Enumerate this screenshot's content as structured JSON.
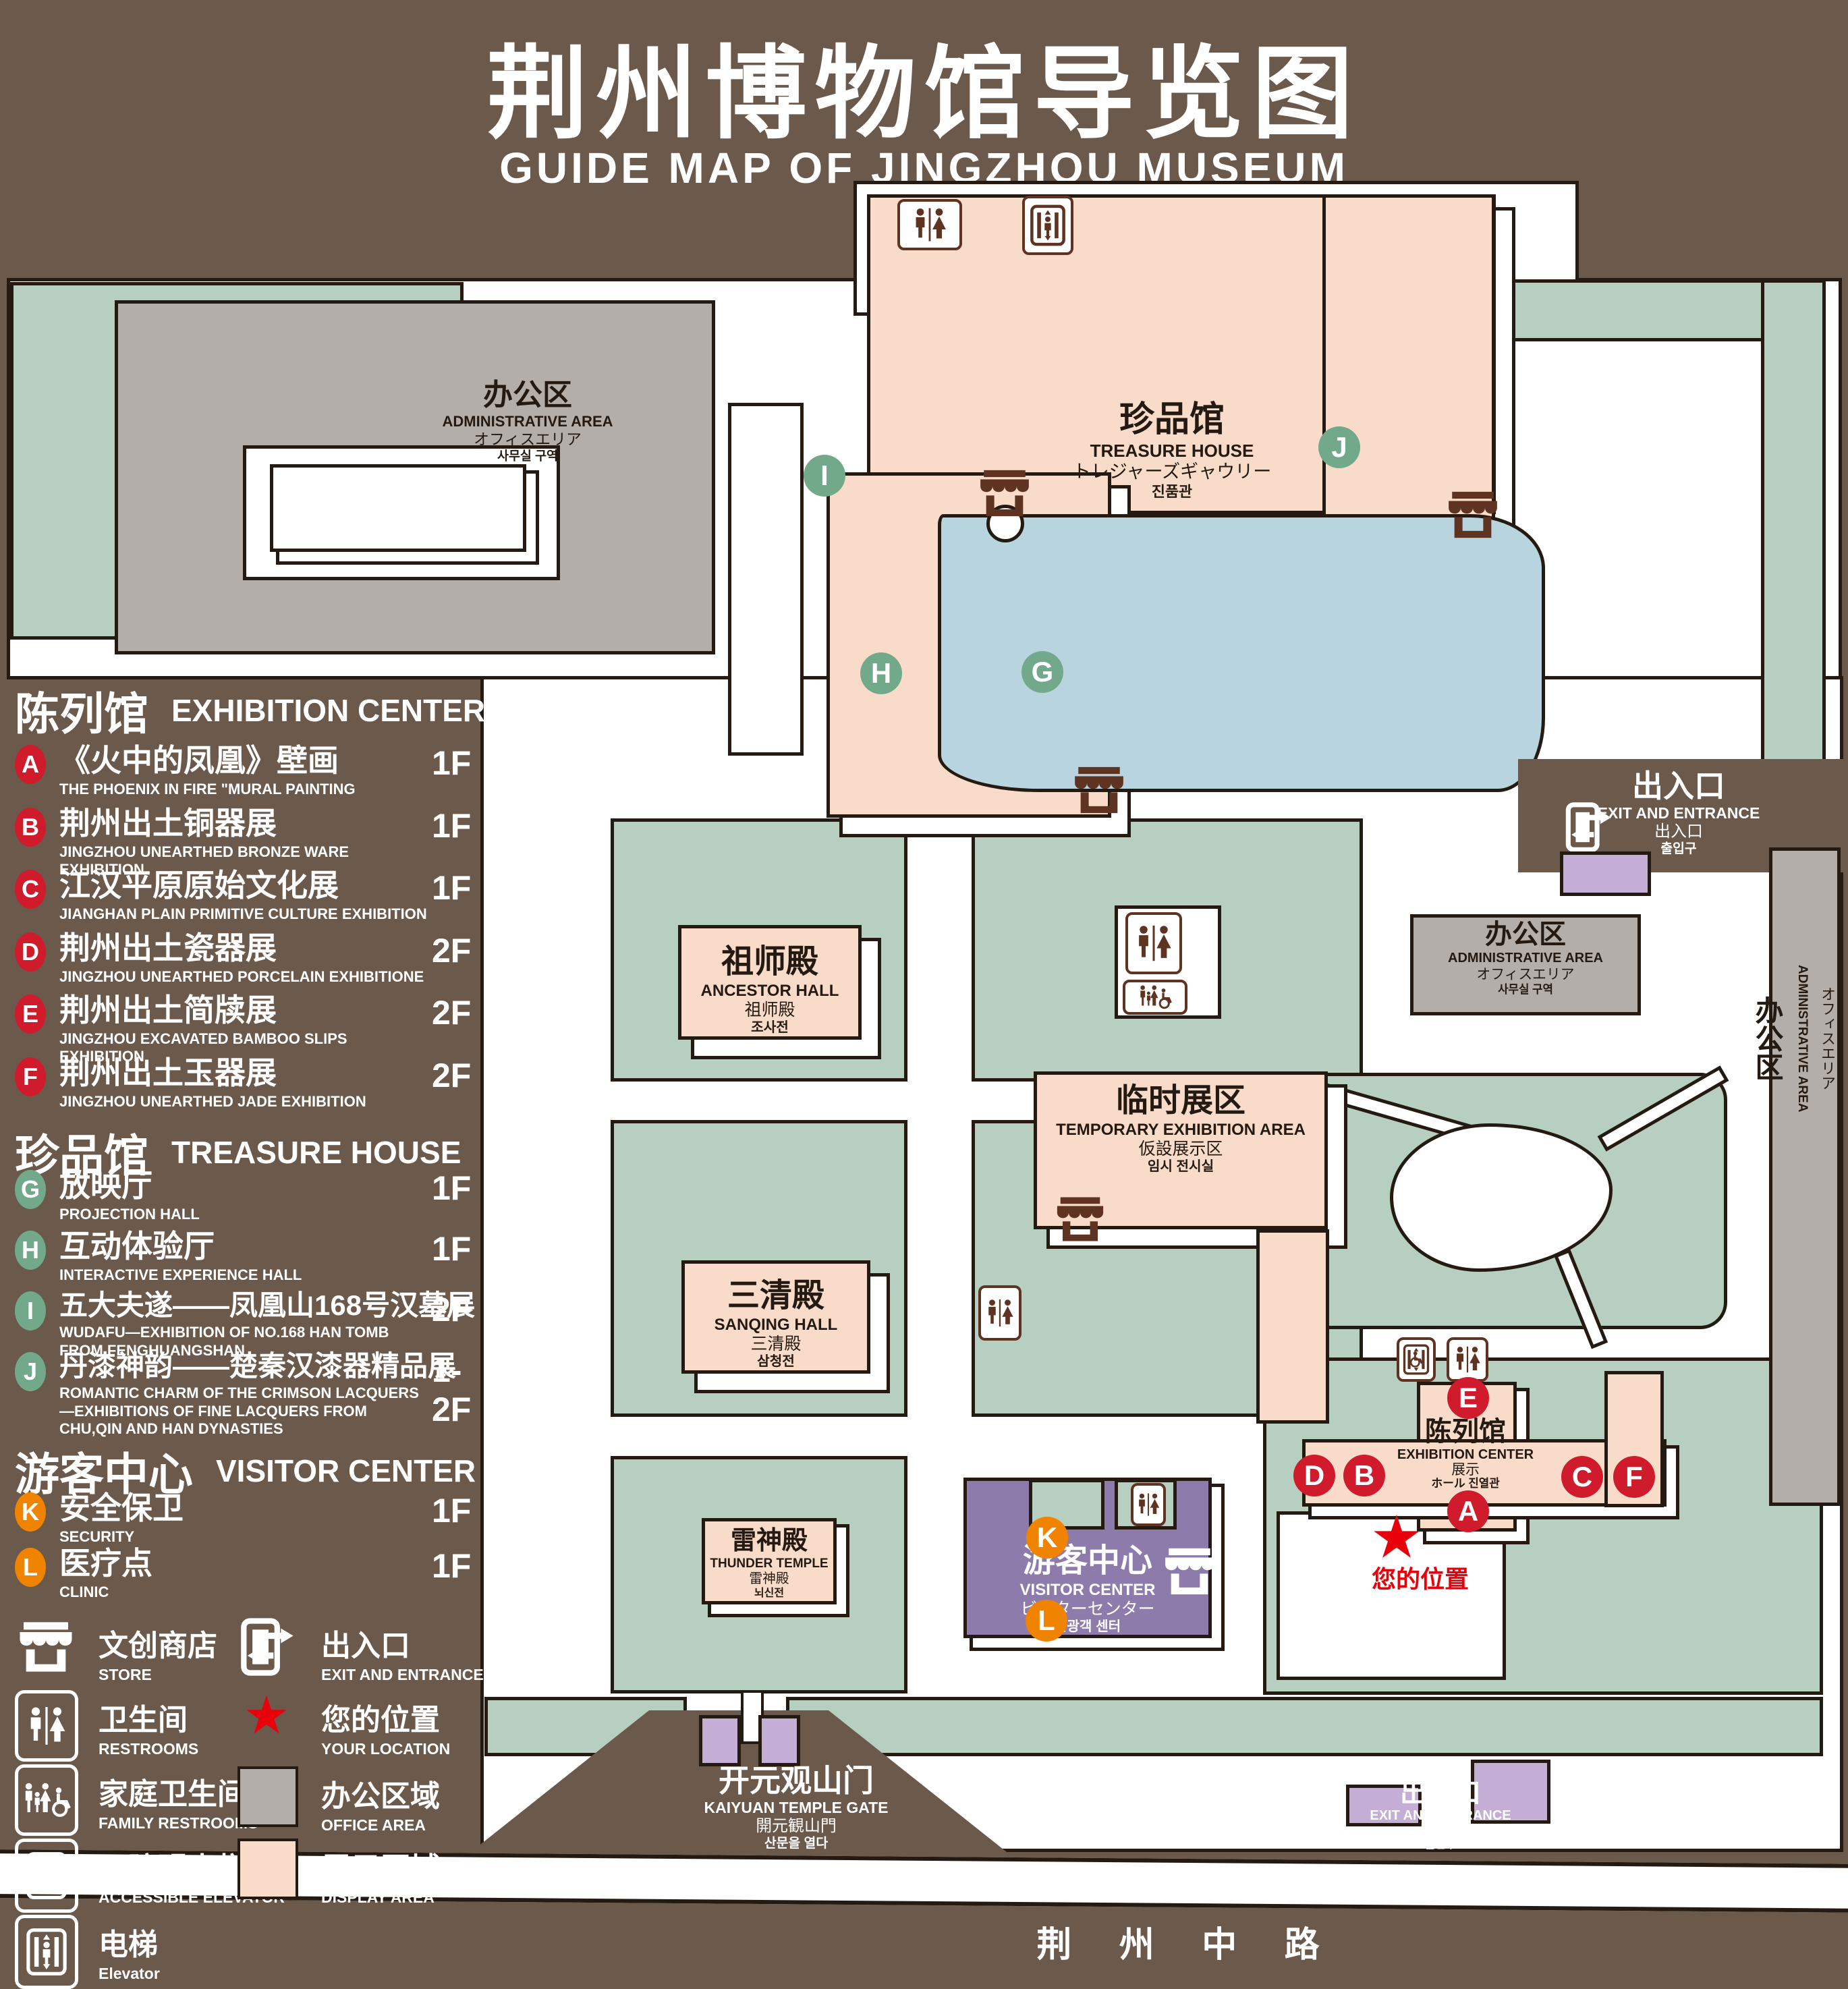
{
  "title": {
    "zh": "荆州博物馆导览图",
    "en": "GUIDE MAP OF JINGZHOU MUSEUM"
  },
  "colors": {
    "background_brown": "#6b5a4b",
    "lawn_green": "#b7cfc0",
    "office_gray": "#b4aeab",
    "display_pink": "#f9dbc9",
    "pond_blue": "#b8d4df",
    "visitor_purple": "#8d7bab",
    "small_building_lavender": "#c4aed6",
    "marker_red": "#cf1b2b",
    "marker_green": "#72a98b",
    "marker_orange": "#f08300",
    "icon_brown": "#5e3322",
    "star_red": "#e8000a",
    "outline": "#241a11"
  },
  "legend": {
    "sections": [
      {
        "zh": "陈列馆",
        "en": "EXHIBITION CENTER",
        "items": [
          {
            "letter": "A",
            "zh": "《火中的凤凰》壁画",
            "en": "THE PHOENIX IN FIRE \"MURAL PAINTING",
            "floor": "1F"
          },
          {
            "letter": "B",
            "zh": "荆州出土铜器展",
            "en": "JINGZHOU UNEARTHED BRONZE WARE EXHIBITION",
            "floor": "1F"
          },
          {
            "letter": "C",
            "zh": "江汉平原原始文化展",
            "en": "JIANGHAN PLAIN PRIMITIVE CULTURE EXHIBITION",
            "floor": "1F"
          },
          {
            "letter": "D",
            "zh": "荆州出土瓷器展",
            "en": "JINGZHOU UNEARTHED PORCELAIN EXHIBITIONE",
            "floor": "2F"
          },
          {
            "letter": "E",
            "zh": "荆州出土简牍展",
            "en": "JINGZHOU EXCAVATED BAMBOO SLIPS EXHIBITION",
            "floor": "2F"
          },
          {
            "letter": "F",
            "zh": "荆州出土玉器展",
            "en": "JINGZHOU UNEARTHED JADE EXHIBITION",
            "floor": "2F"
          }
        ]
      },
      {
        "zh": "珍品馆",
        "en": "TREASURE HOUSE",
        "items": [
          {
            "letter": "G",
            "zh": "放映厅",
            "en": "PROJECTION HALL",
            "floor": "1F"
          },
          {
            "letter": "H",
            "zh": "互动体验厅",
            "en": "INTERACTIVE EXPERIENCE HALL",
            "floor": "1F"
          },
          {
            "letter": "I",
            "zh": "五大夫遂——凤凰山168号汉墓展",
            "en": "WUDAFU—EXHIBITION OF NO.168 HAN TOMB FROM FENGHUANGSHAN",
            "floor": "2F"
          },
          {
            "letter": "J",
            "zh": "丹漆神韵——楚秦汉漆器精品展",
            "en": "ROMANTIC CHARM OF THE CRIMSON LACQUERS—EXHIBITIONS OF FINE LACQUERS FROM CHU,QIN AND HAN DYNASTIES",
            "floor": "1-2F"
          }
        ]
      },
      {
        "zh": "游客中心",
        "en": "VISITOR CENTER",
        "items": [
          {
            "letter": "K",
            "zh": "安全保卫",
            "en": "SECURITY",
            "floor": "1F"
          },
          {
            "letter": "L",
            "zh": "医疗点",
            "en": "CLINIC",
            "floor": "1F"
          }
        ]
      }
    ],
    "symbols_left": [
      {
        "zh": "文创商店",
        "en": "STORE",
        "icon": "store-icon"
      },
      {
        "zh": "卫生间",
        "en": "RESTROOMS",
        "icon": "restroom-icon"
      },
      {
        "zh": "家庭卫生间",
        "en": "FAMILY RESTROOMS",
        "icon": "family-restroom-icon"
      },
      {
        "zh": "无障碍电梯",
        "en": "ACCESSIBLE ELEVATOR",
        "icon": "accessible-elevator-icon"
      },
      {
        "zh": "电梯",
        "en": "Elevator",
        "icon": "elevator-icon"
      }
    ],
    "symbols_right": [
      {
        "zh": "出入口",
        "en": "EXIT AND ENTRANCE",
        "icon": "exit-icon"
      },
      {
        "zh": "您的位置",
        "en": "YOUR LOCATION",
        "icon": "location-star-icon"
      },
      {
        "zh": "办公区域",
        "en": "OFFICE AREA",
        "icon": "office-swatch"
      },
      {
        "zh": "展示区域",
        "en": "DISPLAY AREA",
        "icon": "display-swatch"
      }
    ]
  },
  "map": {
    "buildings": {
      "admin_nw": {
        "zh": "办公区",
        "en": "ADMINISTRATIVE AREA",
        "jp": "オフィスエリア",
        "kr": "사무실 구역"
      },
      "treasure": {
        "zh": "珍品馆",
        "en": "TREASURE HOUSE",
        "jp": "トレジャーズギャウリー",
        "kr": "진품관"
      },
      "admin_mid": {
        "zh": "办公区",
        "en": "ADMINISTRATIVE AREA",
        "jp": "オフィスエリア",
        "kr": "사무실 구역"
      },
      "admin_east": {
        "zh": "办公区",
        "en": "ADMINISTRATIVE AREA",
        "jp": "オフィスエリア",
        "kr": "사무실 구역"
      },
      "ancestor": {
        "zh": "祖师殿",
        "en": "ANCESTOR HALL",
        "jp": "祖师殿",
        "kr": "조사전"
      },
      "temporary": {
        "zh": "临时展区",
        "en": "TEMPORARY EXHIBITION AREA",
        "jp": "仮設展示区",
        "kr": "임시 전시실"
      },
      "sanqing": {
        "zh": "三清殿",
        "en": "SANQING HALL",
        "jp": "三清殿",
        "kr": "삼청전"
      },
      "thunder": {
        "zh": "雷神殿",
        "en": "THUNDER TEMPLE",
        "jp": "雷神殿",
        "kr": "뇌신전"
      },
      "visitor": {
        "zh": "游客中心",
        "en": "VISITOR CENTER",
        "jp": "ビジターセンター",
        "kr": "관광객 센터"
      },
      "exhibition": {
        "zh": "陈列馆",
        "en": "EXHIBITION CENTER",
        "jp": "展示",
        "kr": "ホール 진열관"
      },
      "gate": {
        "zh": "开元观山门",
        "en": "KAIYUAN TEMPLE GATE",
        "jp": "開元観山門",
        "kr": "산문을 열다"
      },
      "exit_ne": {
        "zh": "出入口",
        "en": "EXIT AND ENTRANCE",
        "jp": "出入口",
        "kr": "출입구"
      },
      "exit_s": {
        "zh": "出入口",
        "en": "EXIT AND ENTRANCE",
        "jp": "出入口",
        "kr": "출입구"
      }
    },
    "markers": {
      "a": "A",
      "b": "B",
      "c": "C",
      "d": "D",
      "e": "E",
      "f": "F",
      "g": "G",
      "h": "H",
      "i": "I",
      "j": "J",
      "k": "K",
      "l": "L"
    },
    "your_location": "您的位置",
    "road": "荆 州 中 路"
  }
}
